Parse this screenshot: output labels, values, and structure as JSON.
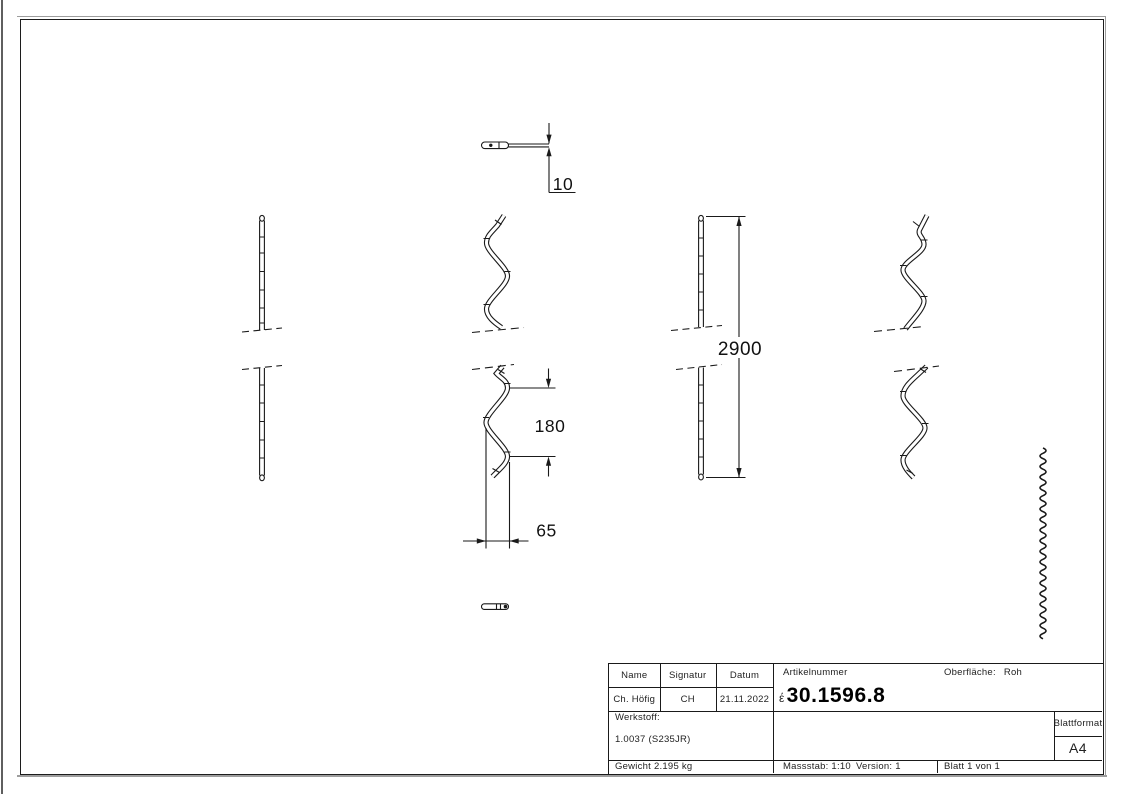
{
  "drawing": {
    "dimensions": {
      "thickness": "10",
      "wave_height": "180",
      "wave_width": "65",
      "total_length": "2900"
    }
  },
  "title_block": {
    "name_label": "Name",
    "signature_label": "Signatur",
    "date_label": "Datum",
    "name_value": "Ch. Höfig",
    "signature_value": "CH",
    "date_value": "21.11.2022",
    "article_label": "Artikelnummer",
    "article_prefix": "έ",
    "article_number": "30.1596.8",
    "surface_label": "Oberfläche:",
    "surface_value": "Roh",
    "material_label": "Werkstoff:",
    "material_value": "1.0037 (S235JR)",
    "weight_text": "Gewicht 2.195 kg",
    "scale_text": "Massstab: 1:10",
    "version_text": "Version: 1",
    "sheet_count_text": "Blatt 1 von 1",
    "format_label": "Blattformat",
    "format_value": "A4"
  }
}
